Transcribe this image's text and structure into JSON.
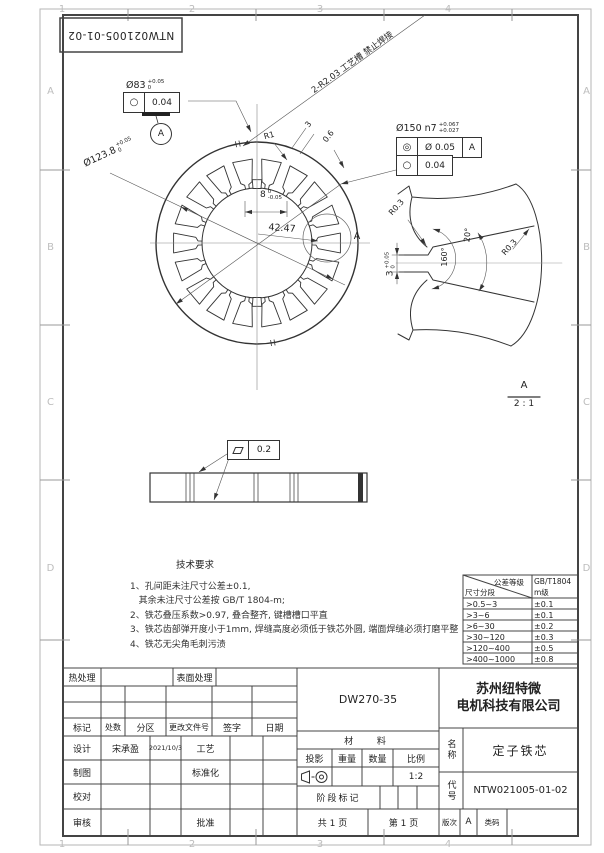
{
  "sheet": {
    "zones_h": [
      "1",
      "2",
      "3",
      "4"
    ],
    "zones_v": [
      "A",
      "B",
      "C",
      "D"
    ],
    "stamp": "NTW021005-01-02"
  },
  "main_view": {
    "bore": {
      "dim": "Ø83",
      "tol_up": "+0.05",
      "tol_dn": "0",
      "fcf_sym": "○",
      "fcf_val": "0.04",
      "datum": "A"
    },
    "od": {
      "dim": "Ø150 n7",
      "tol_up": "+0.067",
      "tol_dn": "+0.027",
      "fcf1_sym": "◎",
      "fcf1_val": "Ø 0.05",
      "fcf1_datum": "A",
      "fcf2_sym": "○",
      "fcf2_val": "0.04"
    },
    "slot_circle": {
      "dim": "Ø123.8",
      "tol_up": "+0.05",
      "tol_dn": "0"
    },
    "groove_note": "2-R2.03 工艺槽 禁止焊接",
    "r1": "R1",
    "dim_3": "3",
    "dim_06": "0.6",
    "dim_8": {
      "val": "8",
      "tol_up": "0",
      "tol_dn": "-0.05"
    },
    "dim_4247": "42.47",
    "detail_mark": "A"
  },
  "detail_view": {
    "r03_a": "R0.3",
    "r03_b": "R0.3",
    "angle_160": "160°",
    "angle_20": "20°",
    "dim_3": {
      "val": "3",
      "tol_up": "+0.05",
      "tol_dn": "0"
    },
    "label": "A",
    "scale": "2 : 1"
  },
  "stack_view": {
    "flatness_val": "0.2"
  },
  "tech_req": {
    "title": "技术要求",
    "lines": [
      "1、孔间距未注尺寸公差±0.1,",
      "   其余未注尺寸公差按 GB/T 1804-m;",
      "2、铁芯叠压系数>0.97, 叠合整齐, 键槽槽口平直",
      "3、铁芯齿部弹开度小于1mm, 焊缝高度必须低于铁芯外圆, 端面焊缝必须打磨平整",
      "4、铁芯无尖角毛刺污渍"
    ]
  },
  "tol_table": {
    "hdr_grade": "公差等级",
    "hdr_seg": "尺寸分段",
    "hdr_std": "GB/T1804",
    "hdr_level": "m级",
    "rows": [
      [
        ">0.5~3",
        "±0.1"
      ],
      [
        ">3~6",
        "±0.1"
      ],
      [
        ">6~30",
        "±0.2"
      ],
      [
        ">30~120",
        "±0.3"
      ],
      [
        ">120~400",
        "±0.5"
      ],
      [
        ">400~1000",
        "±0.8"
      ]
    ]
  },
  "title_block": {
    "heat": "热处理",
    "surface": "表面处理",
    "rev_cols": [
      "标记",
      "处数",
      "分区",
      "更改文件号",
      "签字",
      "日期"
    ],
    "design": "设计",
    "designer": "宋承盈",
    "date": "2021/10/3",
    "craft": "工艺",
    "draft": "制图",
    "standard": "标准化",
    "proof": "校对",
    "audit": "审核",
    "approve": "批准",
    "material_value": "DW270-35",
    "material": "材  料",
    "projection": "投影",
    "weight": "重量",
    "quantity": "数量",
    "ratio": "比例",
    "ratio_value": "1:2",
    "stage": "阶段标记",
    "pages": "共 1 页",
    "page": "第 1 页",
    "company1": "苏州纽特微",
    "company2": "电机科技有限公司",
    "name_label": "名称",
    "name": "定子铁芯",
    "code_label": "代号",
    "code": "NTW021005-01-02",
    "rev": "版次",
    "rev_value": "A",
    "class": "类码"
  }
}
